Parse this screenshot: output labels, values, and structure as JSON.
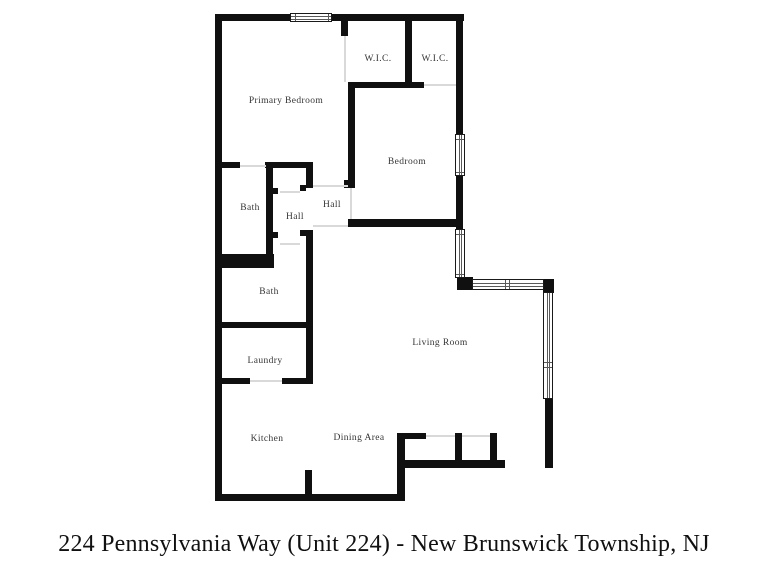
{
  "caption": {
    "text": "224 Pennsylvania Way (Unit 224) - New Brunswick Township, NJ"
  },
  "floorplan": {
    "wall_color": "#101010",
    "background": "#ffffff",
    "rooms": [
      {
        "label": "Primary Bedroom",
        "x": 286,
        "y": 101
      },
      {
        "label": "W.I.C.",
        "x": 378,
        "y": 59
      },
      {
        "label": "W.I.C.",
        "x": 435,
        "y": 59
      },
      {
        "label": "Bedroom",
        "x": 407,
        "y": 162
      },
      {
        "label": "Bath",
        "x": 250,
        "y": 208
      },
      {
        "label": "Hall",
        "x": 295,
        "y": 217
      },
      {
        "label": "Hall",
        "x": 332,
        "y": 205
      },
      {
        "label": "Bath",
        "x": 269,
        "y": 292
      },
      {
        "label": "Laundry",
        "x": 265,
        "y": 361
      },
      {
        "label": "Living Room",
        "x": 440,
        "y": 343
      },
      {
        "label": "Kitchen",
        "x": 267,
        "y": 439
      },
      {
        "label": "Dining Area",
        "x": 359,
        "y": 438
      }
    ],
    "walls": [
      [
        215,
        14,
        249,
        7
      ],
      [
        215,
        14,
        7,
        487
      ],
      [
        215,
        494,
        190,
        7
      ],
      [
        456,
        14,
        7,
        263
      ],
      [
        457,
        277,
        16,
        13
      ],
      [
        543,
        279,
        11,
        14
      ],
      [
        545,
        398,
        8,
        70
      ],
      [
        341,
        21,
        7,
        15
      ],
      [
        348,
        82,
        7,
        106
      ],
      [
        344,
        180,
        4,
        8
      ],
      [
        405,
        21,
        7,
        64
      ],
      [
        348,
        82,
        76,
        6
      ],
      [
        348,
        219,
        115,
        8
      ],
      [
        215,
        162,
        25,
        6
      ],
      [
        265,
        162,
        48,
        6
      ],
      [
        266,
        162,
        7,
        94
      ],
      [
        222,
        254,
        52,
        14
      ],
      [
        306,
        162,
        7,
        26
      ],
      [
        306,
        230,
        7,
        154
      ],
      [
        215,
        322,
        98,
        6
      ],
      [
        215,
        378,
        35,
        6
      ],
      [
        282,
        378,
        31,
        6
      ],
      [
        305,
        470,
        7,
        26
      ],
      [
        397,
        433,
        8,
        68
      ],
      [
        397,
        433,
        29,
        6
      ],
      [
        455,
        433,
        7,
        29
      ],
      [
        490,
        433,
        7,
        29
      ],
      [
        402,
        460,
        103,
        8
      ],
      [
        273,
        188,
        5,
        6
      ],
      [
        273,
        232,
        5,
        6
      ],
      [
        300,
        185,
        6,
        6
      ],
      [
        300,
        230,
        6,
        6
      ]
    ],
    "windows": [
      {
        "x": 290,
        "y": 13,
        "w": 42,
        "h": 9,
        "o": "h",
        "m": [
          4,
          37
        ]
      },
      {
        "x": 455,
        "y": 134,
        "w": 10,
        "h": 42,
        "o": "v",
        "m": [
          4,
          37
        ]
      },
      {
        "x": 455,
        "y": 229,
        "w": 10,
        "h": 49,
        "o": "v",
        "m": [
          4,
          44
        ]
      },
      {
        "x": 472,
        "y": 279,
        "w": 72,
        "h": 11,
        "o": "h",
        "m": [
          32,
          36
        ]
      },
      {
        "x": 543,
        "y": 292,
        "w": 10,
        "h": 107,
        "o": "v",
        "m": [
          69,
          74
        ]
      }
    ],
    "thresholds": [
      [
        240,
        165,
        26,
        2
      ],
      [
        344,
        36,
        2,
        46
      ],
      [
        424,
        84,
        32,
        2
      ],
      [
        350,
        188,
        2,
        31
      ],
      [
        280,
        191,
        20,
        2
      ],
      [
        280,
        243,
        20,
        2
      ],
      [
        313,
        185,
        35,
        2
      ],
      [
        313,
        225,
        35,
        2
      ],
      [
        250,
        380,
        32,
        2
      ],
      [
        426,
        435,
        29,
        2
      ],
      [
        462,
        435,
        28,
        2
      ]
    ]
  }
}
